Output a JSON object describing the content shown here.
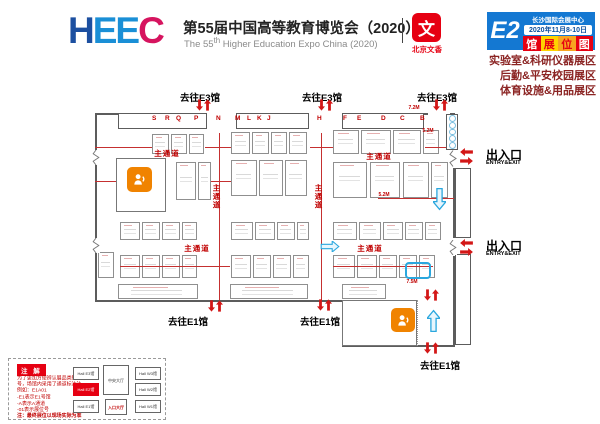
{
  "colors": {
    "red": "#e60012",
    "blue": "#1478d2",
    "orange": "#f08300",
    "maroon": "#8b2423",
    "arrow_blue": "#2aa7de"
  },
  "header": {
    "logo_letters": [
      {
        "ch": "H",
        "color": "#1c4fa0"
      },
      {
        "ch": "E",
        "color": "#1a8fd6"
      },
      {
        "ch": "E",
        "color": "#1a8fd6"
      },
      {
        "ch": "C",
        "color": "#d6145f"
      }
    ],
    "title_cn": "第55届中国高等教育博览会（2020）",
    "title_en_prefix": "The 55",
    "title_en_sup": "th",
    "title_en_suffix": " Higher Education Expo China (2020)",
    "seal_glyph": "文",
    "seal_name": "北京文香",
    "badge": {
      "hall": "E2",
      "venue": "长沙国际会展中心",
      "dates": "2020年11月8-10日",
      "map_chars": [
        "馆",
        "展",
        "位",
        "图"
      ],
      "map_bg": [
        "#e60012",
        "#ffd400",
        "#f7a520",
        "#e60012"
      ],
      "map_fg": [
        "#ffffff",
        "#e60012",
        "#e60012",
        "#ffffff"
      ]
    },
    "zones": [
      "实验室&科研仪器展区",
      "后勤&平安校园展区",
      "体育设施&用品展区"
    ]
  },
  "floorplan": {
    "walls": [
      [
        95,
        113,
        25,
        2
      ],
      [
        424,
        113,
        4,
        2
      ],
      [
        450,
        113,
        5,
        2
      ],
      [
        95,
        113,
        2,
        37
      ],
      [
        95,
        164,
        2,
        74
      ],
      [
        95,
        252,
        2,
        50
      ],
      [
        95,
        300,
        247,
        2
      ],
      [
        342,
        345,
        113,
        2
      ],
      [
        453,
        113,
        2,
        35
      ],
      [
        453,
        168,
        2,
        70
      ],
      [
        453,
        256,
        2,
        91
      ],
      [
        342,
        300,
        2,
        46
      ]
    ],
    "wall_strips": [
      [
        118,
        113,
        89,
        16
      ],
      [
        236,
        113,
        73,
        16
      ],
      [
        342,
        113,
        82,
        16
      ]
    ],
    "corridors": [
      [
        455,
        168,
        16,
        70
      ],
      [
        455,
        254,
        16,
        91
      ]
    ],
    "booths": [
      [
        152,
        134,
        17,
        20
      ],
      [
        171,
        134,
        16,
        20
      ],
      [
        189,
        134,
        15,
        20
      ],
      [
        176,
        162,
        20,
        38
      ],
      [
        198,
        162,
        13,
        38
      ],
      [
        120,
        222,
        20,
        18
      ],
      [
        142,
        222,
        18,
        18
      ],
      [
        162,
        222,
        18,
        18
      ],
      [
        182,
        222,
        15,
        18
      ],
      [
        98,
        252,
        16,
        26
      ],
      [
        120,
        255,
        20,
        23
      ],
      [
        142,
        255,
        18,
        23
      ],
      [
        162,
        255,
        18,
        23
      ],
      [
        182,
        255,
        15,
        23
      ],
      [
        231,
        132,
        19,
        22
      ],
      [
        252,
        132,
        17,
        22
      ],
      [
        271,
        132,
        16,
        22
      ],
      [
        289,
        132,
        18,
        22
      ],
      [
        231,
        160,
        26,
        36
      ],
      [
        259,
        160,
        24,
        36
      ],
      [
        285,
        160,
        22,
        36
      ],
      [
        231,
        222,
        22,
        18
      ],
      [
        255,
        222,
        20,
        18
      ],
      [
        277,
        222,
        18,
        18
      ],
      [
        297,
        222,
        12,
        18
      ],
      [
        231,
        255,
        20,
        23
      ],
      [
        253,
        255,
        18,
        23
      ],
      [
        273,
        255,
        18,
        23
      ],
      [
        293,
        255,
        16,
        23
      ],
      [
        333,
        130,
        26,
        24
      ],
      [
        361,
        130,
        30,
        24
      ],
      [
        393,
        130,
        28,
        24
      ],
      [
        423,
        130,
        16,
        24
      ],
      [
        333,
        162,
        34,
        36
      ],
      [
        370,
        162,
        30,
        36
      ],
      [
        403,
        162,
        26,
        36
      ],
      [
        431,
        162,
        17,
        36
      ],
      [
        333,
        222,
        24,
        18
      ],
      [
        359,
        222,
        22,
        18
      ],
      [
        383,
        222,
        20,
        18
      ],
      [
        405,
        222,
        18,
        18
      ],
      [
        425,
        222,
        16,
        18
      ],
      [
        333,
        255,
        22,
        23
      ],
      [
        357,
        255,
        20,
        23
      ],
      [
        379,
        255,
        18,
        23
      ],
      [
        399,
        255,
        18,
        23
      ],
      [
        419,
        255,
        16,
        23
      ],
      [
        118,
        284,
        80,
        15
      ],
      [
        230,
        284,
        78,
        15
      ],
      [
        342,
        284,
        44,
        15
      ]
    ],
    "red_lines": [
      [
        219,
        133,
        1,
        167
      ],
      [
        321,
        133,
        1,
        167
      ],
      [
        95,
        147,
        57,
        1
      ],
      [
        205,
        147,
        26,
        1
      ],
      [
        310,
        147,
        23,
        1
      ],
      [
        425,
        147,
        28,
        1
      ],
      [
        95,
        181,
        23,
        1
      ],
      [
        211,
        181,
        20,
        1
      ],
      [
        378,
        198,
        76,
        1
      ],
      [
        120,
        266,
        110,
        1
      ],
      [
        333,
        266,
        100,
        1
      ]
    ],
    "letter_y": 115,
    "aisle_letters": [
      {
        "ch": "S",
        "x": 155
      },
      {
        "ch": "R",
        "x": 168
      },
      {
        "ch": "Q",
        "x": 179
      },
      {
        "ch": "P",
        "x": 197
      },
      {
        "ch": "N",
        "x": 219
      },
      {
        "ch": "M",
        "x": 238
      },
      {
        "ch": "L",
        "x": 250
      },
      {
        "ch": "K",
        "x": 260
      },
      {
        "ch": "J",
        "x": 270
      },
      {
        "ch": "H",
        "x": 320
      },
      {
        "ch": "F",
        "x": 346
      },
      {
        "ch": "E",
        "x": 360
      },
      {
        "ch": "D",
        "x": 384
      },
      {
        "ch": "C",
        "x": 403
      },
      {
        "ch": "B",
        "x": 423
      }
    ],
    "labels": [
      {
        "name": "to-e3-label",
        "cls": "dest",
        "x": 177,
        "y": 90,
        "w": 46,
        "text": "去往E3馆"
      },
      {
        "name": "to-e3-label",
        "cls": "dest",
        "x": 299,
        "y": 90,
        "w": 46,
        "text": "去往E3馆"
      },
      {
        "name": "to-e3-label",
        "cls": "dest",
        "x": 414,
        "y": 90,
        "w": 46,
        "text": "去往E3馆"
      },
      {
        "name": "to-e1-label",
        "cls": "dest",
        "x": 165,
        "y": 314,
        "w": 46,
        "text": "去往E1馆"
      },
      {
        "name": "to-e1-label",
        "cls": "dest",
        "x": 297,
        "y": 314,
        "w": 46,
        "text": "去往E1馆"
      },
      {
        "name": "to-e1-label",
        "cls": "dest",
        "x": 417,
        "y": 358,
        "w": 46,
        "text": "去往E1馆"
      },
      {
        "name": "entry-exit-label",
        "cls": "gate",
        "x": 486,
        "y": 146,
        "w": 60,
        "text": "出入口"
      },
      {
        "name": "entry-exit-en",
        "cls": "gate-en",
        "x": 486,
        "y": 160,
        "w": 60,
        "text": "ENTRY&EXIT"
      },
      {
        "name": "entry-exit-label",
        "cls": "gate",
        "x": 486,
        "y": 237,
        "w": 60,
        "text": "出入口"
      },
      {
        "name": "entry-exit-en",
        "cls": "gate-en",
        "x": 486,
        "y": 251,
        "w": 60,
        "text": "ENTRY&EXIT"
      },
      {
        "name": "main-aisle-label",
        "cls": "aisle-h",
        "x": 150,
        "y": 148,
        "w": 34,
        "text": "主通道"
      },
      {
        "name": "main-aisle-label",
        "cls": "aisle-h",
        "x": 362,
        "y": 151,
        "w": 34,
        "text": "主通道"
      },
      {
        "name": "main-aisle-label",
        "cls": "aisle-h",
        "x": 180,
        "y": 243,
        "w": 34,
        "text": "主通道"
      },
      {
        "name": "main-aisle-label",
        "cls": "aisle-h",
        "x": 353,
        "y": 243,
        "w": 34,
        "text": "主通道"
      },
      {
        "name": "main-aisle-label",
        "cls": "aisle-v",
        "x": 212,
        "y": 184,
        "w": 10,
        "text": "主通道"
      },
      {
        "name": "main-aisle-label",
        "cls": "aisle-v",
        "x": 314,
        "y": 184,
        "w": 10,
        "text": "主通道"
      },
      {
        "name": "conference-room-label",
        "cls": "room-label",
        "x": 116,
        "y": 196,
        "w": 50,
        "text": "E2馆\n会议室"
      },
      {
        "name": "conference-room-label",
        "cls": "room-label",
        "x": 345,
        "y": 308,
        "w": 46,
        "text": "E1-E2馆间\n会议室"
      },
      {
        "name": "dimension-label",
        "cls": "dim",
        "x": 406,
        "y": 105,
        "w": 16,
        "text": "7.2M"
      },
      {
        "name": "dimension-label",
        "cls": "dim",
        "x": 420,
        "y": 128,
        "w": 16,
        "text": "5.2M"
      },
      {
        "name": "dimension-label",
        "cls": "dim",
        "x": 376,
        "y": 192,
        "w": 16,
        "text": "5.2M"
      },
      {
        "name": "dimension-label",
        "cls": "dim",
        "x": 404,
        "y": 279,
        "w": 16,
        "text": "7.5M"
      }
    ],
    "arrows": [
      {
        "type": "rv",
        "x": 196,
        "y": 98
      },
      {
        "type": "rv",
        "x": 318,
        "y": 98
      },
      {
        "type": "rv",
        "x": 433,
        "y": 98
      },
      {
        "type": "rv",
        "x": 208,
        "y": 299
      },
      {
        "type": "rv",
        "x": 317,
        "y": 298
      },
      {
        "type": "rv",
        "x": 424,
        "y": 288
      },
      {
        "type": "rv",
        "x": 424,
        "y": 341
      },
      {
        "type": "rh",
        "x": 459,
        "y": 148
      },
      {
        "type": "rh",
        "x": 459,
        "y": 239
      },
      {
        "type": "bd",
        "x": 433,
        "y": 183
      },
      {
        "type": "bu",
        "x": 427,
        "y": 303
      },
      {
        "type": "br",
        "x": 314,
        "y": 241
      }
    ],
    "doors": [
      [
        92,
        150,
        8,
        15
      ],
      [
        92,
        238,
        8,
        15
      ],
      [
        449,
        150,
        8,
        17
      ],
      [
        449,
        240,
        8,
        15
      ]
    ],
    "highlight_booths": [
      [
        405,
        262,
        26,
        17
      ]
    ],
    "circle_strip": [
      446,
      114,
      12,
      36
    ],
    "rooms": {
      "conf1": {
        "x": 116,
        "y": 158,
        "w": 50,
        "h": 54,
        "icon": [
          127,
          167,
          25,
          25
        ]
      },
      "conf2": {
        "x": 342,
        "y": 300,
        "w": 75,
        "h": 46,
        "icon": [
          391,
          308,
          24,
          24
        ],
        "dotted_x": 417
      }
    }
  },
  "legend": {
    "title": "注 解",
    "lines": [
      {
        "text": "为了更加方便辨认展品类别和编",
        "strong": false
      },
      {
        "text": "号，场馆内采用了通道标注法。",
        "strong": false
      },
      {
        "text": "例如：E1A01",
        "strong": false
      },
      {
        "text": "-E1表示E1号馆",
        "strong": false
      },
      {
        "text": "-A表示A通道",
        "strong": false
      },
      {
        "text": "-01表示展位号",
        "strong": false
      },
      {
        "text": "注：最终展位以现场实际为准",
        "strong": true
      }
    ],
    "minimap": {
      "halls": [
        {
          "label": "Hall E3馆",
          "x": 2,
          "y": 4,
          "w": 26,
          "h": 13,
          "cls": ""
        },
        {
          "label": "Hall E2馆",
          "x": 2,
          "y": 20,
          "w": 26,
          "h": 13,
          "cls": "hot"
        },
        {
          "label": "Hall E1馆",
          "x": 2,
          "y": 37,
          "w": 26,
          "h": 13,
          "cls": ""
        },
        {
          "label": "中央大厅",
          "x": 32,
          "y": 2,
          "w": 26,
          "h": 30,
          "cls": ""
        },
        {
          "label": "入口大厅",
          "x": 34,
          "y": 36,
          "w": 22,
          "h": 16,
          "cls": "entr"
        },
        {
          "label": "Hall W3馆",
          "x": 64,
          "y": 4,
          "w": 26,
          "h": 13,
          "cls": ""
        },
        {
          "label": "Hall W2馆",
          "x": 64,
          "y": 20,
          "w": 26,
          "h": 13,
          "cls": ""
        },
        {
          "label": "Hall W1馆",
          "x": 64,
          "y": 37,
          "w": 26,
          "h": 13,
          "cls": ""
        }
      ]
    }
  }
}
